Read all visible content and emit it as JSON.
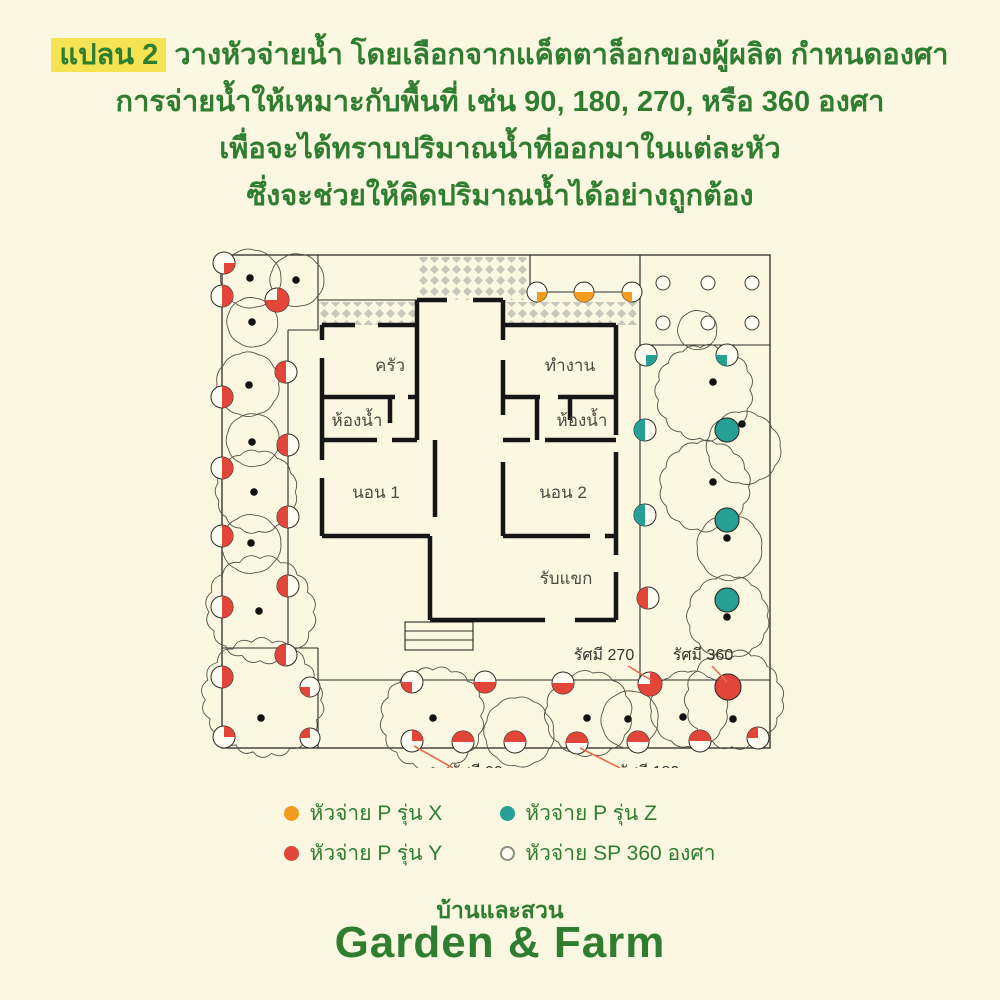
{
  "title": {
    "highlight": "แปลน 2",
    "line1_rest": " วางหัวจ่ายน้ำ โดยเลือกจากแค็ตตาล็อกของผู้ผลิต กำหนดองศา",
    "line2": "การจ่ายน้ำให้เหมาะกับพื้นที่ เช่น 90, 180, 270, หรือ 360 องศา",
    "line3": "เพื่อจะได้ทราบปริมาณน้ำที่ออกมาในแต่ละหัว",
    "line4": "ซึ่งจะช่วยให้คิดปริมาณน้ำได้อย่างถูกต้อง"
  },
  "colors": {
    "background": "#fbf7e0",
    "green_text": "#2e7d30",
    "highlight_yellow": "#f6e353",
    "red": "#e2463a",
    "orange": "#f29c1f",
    "teal": "#26a095",
    "line": "#2b2b26",
    "wall": "#161616",
    "tree": "#55524a",
    "hatch": "#c9c6bb",
    "leader": "#e96a4e",
    "room_label": "#4b4a42",
    "radius_label": "#34332c"
  },
  "plan": {
    "outer_rect": [
      222,
      255,
      770,
      748
    ],
    "thin_lines": [
      [
        318,
        255,
        318,
        330
      ],
      [
        288,
        330,
        288,
        648
      ],
      [
        288,
        330,
        318,
        330
      ],
      [
        222,
        648,
        318,
        648
      ],
      [
        318,
        648,
        318,
        748
      ],
      [
        318,
        300,
        417,
        300
      ],
      [
        530,
        255,
        530,
        292
      ],
      [
        530,
        292,
        640,
        292
      ],
      [
        640,
        255,
        640,
        292
      ],
      [
        640,
        258,
        640,
        345
      ],
      [
        640,
        345,
        770,
        345
      ],
      [
        640,
        345,
        640,
        680
      ],
      [
        318,
        680,
        770,
        680
      ]
    ],
    "hatches": [
      [
        418,
        257,
        110,
        43
      ],
      [
        318,
        302,
        99,
        23
      ],
      [
        507,
        302,
        133,
        23
      ]
    ],
    "stairs": {
      "x": 405,
      "y": 622,
      "w": 68,
      "h": 28,
      "steps": [
        631,
        640
      ]
    },
    "walls": [
      [
        322,
        325,
        355,
        325
      ],
      [
        378,
        325,
        417,
        325
      ],
      [
        503,
        325,
        616,
        325
      ],
      [
        417,
        300,
        447,
        300
      ],
      [
        473,
        300,
        503,
        300
      ],
      [
        417,
        300,
        417,
        397
      ],
      [
        417,
        397,
        417,
        440
      ],
      [
        503,
        300,
        503,
        340
      ],
      [
        503,
        360,
        503,
        415
      ],
      [
        322,
        325,
        322,
        340
      ],
      [
        322,
        358,
        322,
        460
      ],
      [
        322,
        478,
        322,
        536
      ],
      [
        322,
        397,
        395,
        397
      ],
      [
        408,
        397,
        417,
        397
      ],
      [
        322,
        440,
        377,
        440
      ],
      [
        392,
        440,
        417,
        440
      ],
      [
        390,
        397,
        390,
        423
      ],
      [
        435,
        440,
        435,
        517
      ],
      [
        322,
        536,
        430,
        536
      ],
      [
        430,
        536,
        430,
        620
      ],
      [
        430,
        620,
        545,
        620
      ],
      [
        575,
        620,
        616,
        620
      ],
      [
        503,
        397,
        540,
        397
      ],
      [
        558,
        397,
        616,
        397
      ],
      [
        537,
        397,
        537,
        440
      ],
      [
        570,
        397,
        570,
        420
      ],
      [
        503,
        440,
        530,
        440
      ],
      [
        545,
        440,
        616,
        440
      ],
      [
        503,
        462,
        503,
        536
      ],
      [
        503,
        536,
        590,
        536
      ],
      [
        605,
        536,
        616,
        536
      ],
      [
        616,
        325,
        616,
        435
      ],
      [
        616,
        452,
        616,
        555
      ],
      [
        616,
        572,
        616,
        620
      ]
    ],
    "trees": [
      [
        250,
        277,
        30
      ],
      [
        296,
        279,
        27
      ],
      [
        252,
        321,
        25
      ],
      [
        249,
        384,
        31
      ],
      [
        252,
        441,
        27
      ],
      [
        254,
        492,
        40
      ],
      [
        250,
        543,
        30
      ],
      [
        260,
        612,
        52
      ],
      [
        262,
        700,
        57
      ],
      [
        433,
        716,
        50
      ],
      [
        520,
        731,
        34
      ],
      [
        588,
        716,
        42
      ],
      [
        630,
        721,
        29
      ],
      [
        688,
        711,
        38
      ],
      [
        737,
        700,
        48
      ],
      [
        705,
        390,
        47
      ],
      [
        744,
        446,
        36
      ],
      [
        707,
        487,
        44
      ],
      [
        728,
        548,
        33
      ],
      [
        730,
        616,
        40
      ],
      [
        697,
        331,
        20
      ]
    ],
    "tree_dots": [
      [
        250,
        278
      ],
      [
        296,
        280
      ],
      [
        252,
        322
      ],
      [
        249,
        385
      ],
      [
        252,
        442
      ],
      [
        254,
        492
      ],
      [
        251,
        543
      ],
      [
        259,
        611
      ],
      [
        261,
        718
      ],
      [
        433,
        718
      ],
      [
        587,
        718
      ],
      [
        628,
        719
      ],
      [
        683,
        717
      ],
      [
        733,
        719
      ],
      [
        713,
        382
      ],
      [
        742,
        424
      ],
      [
        713,
        482
      ],
      [
        727,
        538
      ],
      [
        727,
        617
      ]
    ],
    "markers": [
      [
        224,
        263,
        11,
        0,
        90,
        "red"
      ],
      [
        222,
        296,
        11,
        270,
        180,
        "red"
      ],
      [
        277,
        300,
        12,
        270,
        270,
        "red"
      ],
      [
        222,
        397,
        11,
        270,
        180,
        "red"
      ],
      [
        222,
        468,
        11,
        270,
        180,
        "red"
      ],
      [
        222,
        536,
        11,
        270,
        180,
        "red"
      ],
      [
        222,
        607,
        11,
        270,
        180,
        "red"
      ],
      [
        222,
        677,
        11,
        270,
        180,
        "red"
      ],
      [
        224,
        737,
        11,
        270,
        90,
        "red"
      ],
      [
        286,
        372,
        11,
        90,
        180,
        "red"
      ],
      [
        288,
        445,
        11,
        90,
        180,
        "red"
      ],
      [
        288,
        517,
        11,
        90,
        180,
        "red"
      ],
      [
        288,
        586,
        11,
        90,
        180,
        "red"
      ],
      [
        286,
        655,
        11,
        90,
        180,
        "red"
      ],
      [
        310,
        687,
        10,
        90,
        90,
        "red"
      ],
      [
        310,
        738,
        10,
        180,
        90,
        "red"
      ],
      [
        412,
        682,
        11,
        90,
        90,
        "red"
      ],
      [
        485,
        682,
        11,
        0,
        180,
        "red"
      ],
      [
        563,
        683,
        11,
        0,
        180,
        "red"
      ],
      [
        650,
        684,
        12,
        270,
        270,
        "red"
      ],
      [
        728,
        687,
        13,
        0,
        360,
        "red"
      ],
      [
        412,
        741,
        11,
        270,
        90,
        "red"
      ],
      [
        463,
        742,
        11,
        180,
        180,
        "red"
      ],
      [
        515,
        742,
        11,
        180,
        180,
        "red"
      ],
      [
        577,
        743,
        11,
        180,
        180,
        "red"
      ],
      [
        638,
        742,
        11,
        180,
        180,
        "red"
      ],
      [
        700,
        741,
        11,
        180,
        180,
        "red"
      ],
      [
        758,
        738,
        11,
        180,
        90,
        "red"
      ],
      [
        646,
        355,
        11,
        0,
        90,
        "teal"
      ],
      [
        727,
        355,
        11,
        90,
        90,
        "teal"
      ],
      [
        645,
        430,
        11,
        90,
        180,
        "teal"
      ],
      [
        645,
        515,
        11,
        90,
        180,
        "teal"
      ],
      [
        648,
        598,
        11,
        90,
        180,
        "red"
      ],
      [
        727,
        430,
        12,
        0,
        360,
        "teal"
      ],
      [
        727,
        520,
        12,
        0,
        360,
        "teal"
      ],
      [
        727,
        600,
        12,
        0,
        360,
        "teal"
      ],
      [
        537,
        292,
        10,
        0,
        90,
        "orange"
      ],
      [
        584,
        292,
        10,
        0,
        180,
        "orange"
      ],
      [
        632,
        292,
        10,
        90,
        90,
        "orange"
      ]
    ],
    "grid_circles": [
      [
        663,
        283
      ],
      [
        708,
        283
      ],
      [
        752,
        283
      ],
      [
        663,
        323
      ],
      [
        708,
        323
      ],
      [
        752,
        323
      ]
    ],
    "grid_circle_r": 7,
    "room_labels": [
      {
        "text": "ครัว",
        "x": 390,
        "y": 371
      },
      {
        "text": "ทำงาน",
        "x": 570,
        "y": 371
      },
      {
        "text": "ห้องน้ำ",
        "x": 357,
        "y": 426
      },
      {
        "text": "ห้องน้ำ",
        "x": 582,
        "y": 426
      },
      {
        "text": "นอน 1",
        "x": 376,
        "y": 498
      },
      {
        "text": "นอน 2",
        "x": 563,
        "y": 498
      },
      {
        "text": "รับแขก",
        "x": 566,
        "y": 584
      }
    ],
    "radius_labels": [
      {
        "text": "รัศมี 270",
        "x": 604,
        "y": 660,
        "x1": 628,
        "y1": 666,
        "x2": 651,
        "y2": 680
      },
      {
        "text": "รัศมี 360",
        "x": 703,
        "y": 660,
        "x1": 712,
        "y1": 666,
        "x2": 727,
        "y2": 682
      },
      {
        "text": "รัศมี 90",
        "x": 477,
        "y": 777,
        "x1": 414,
        "y1": 746,
        "x2": 453,
        "y2": 768
      },
      {
        "text": "รัศมี 180",
        "x": 649,
        "y": 777,
        "x1": 580,
        "y1": 748,
        "x2": 620,
        "y2": 768
      }
    ]
  },
  "legend": {
    "items": [
      {
        "label": "หัวจ่าย P รุ่น X",
        "color": "#f29c1f",
        "type": "dot"
      },
      {
        "label": "หัวจ่าย P รุ่น Y",
        "color": "#e2463a",
        "type": "dot"
      },
      {
        "label": "หัวจ่าย P รุ่น Z",
        "color": "#26a095",
        "type": "dot"
      },
      {
        "label": "หัวจ่าย SP 360 องศา",
        "color": "#fffdf2",
        "type": "ring"
      }
    ]
  },
  "footer": {
    "brand_thai": "บ้านและสวน",
    "brand_en": "Garden & Farm"
  }
}
